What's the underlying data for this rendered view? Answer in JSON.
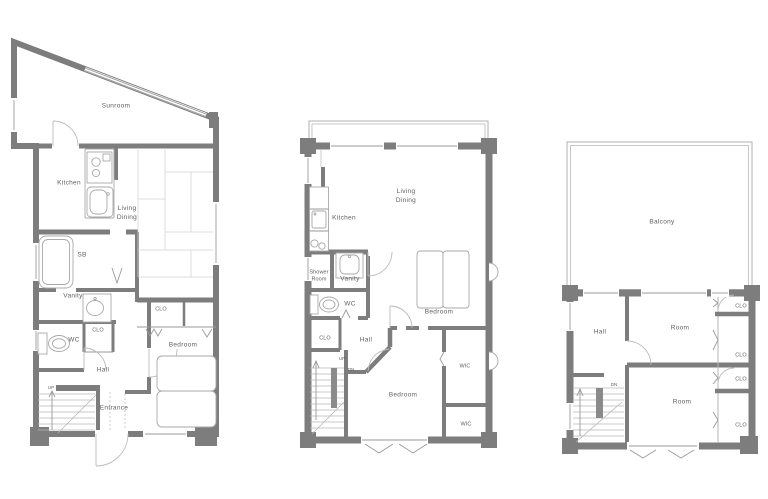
{
  "colors": {
    "wall": "#7d7d7d",
    "fixture_line": "#a8a8a8",
    "text": "#5f5f5f",
    "background": "#ffffff"
  },
  "floor1": {
    "labels": {
      "sunroom": "Sunroom",
      "kitchen": "Kitchen",
      "living_dining": "Living Dining",
      "sb": "SB",
      "vanity": "Vanity",
      "wc": "WC",
      "clo_hall": "CLO",
      "clo_bedroom": "CLO",
      "bedroom": "Bedroom",
      "hall": "Hall",
      "entrance": "Entrance",
      "up": "UP"
    }
  },
  "floor2": {
    "labels": {
      "living_dining": "Living Dining",
      "kitchen": "Kitchen",
      "shower_room": "Shower Room",
      "vanity": "Vanity",
      "wc": "WC",
      "clo": "CLO",
      "hall": "Hall",
      "bedroom_upper": "Bedroom",
      "wic_upper": "WIC",
      "bedroom_lower": "Bedroom",
      "wic_lower": "WIC",
      "up": "UP",
      "dn": "DN"
    }
  },
  "floor3": {
    "labels": {
      "balcony": "Balcony",
      "hall": "Hall",
      "room_upper": "Room",
      "room_lower": "Room",
      "clo_1": "CLO",
      "clo_2": "CLO",
      "clo_3": "CLO",
      "clo_4": "CLO",
      "dn": "DN"
    }
  }
}
